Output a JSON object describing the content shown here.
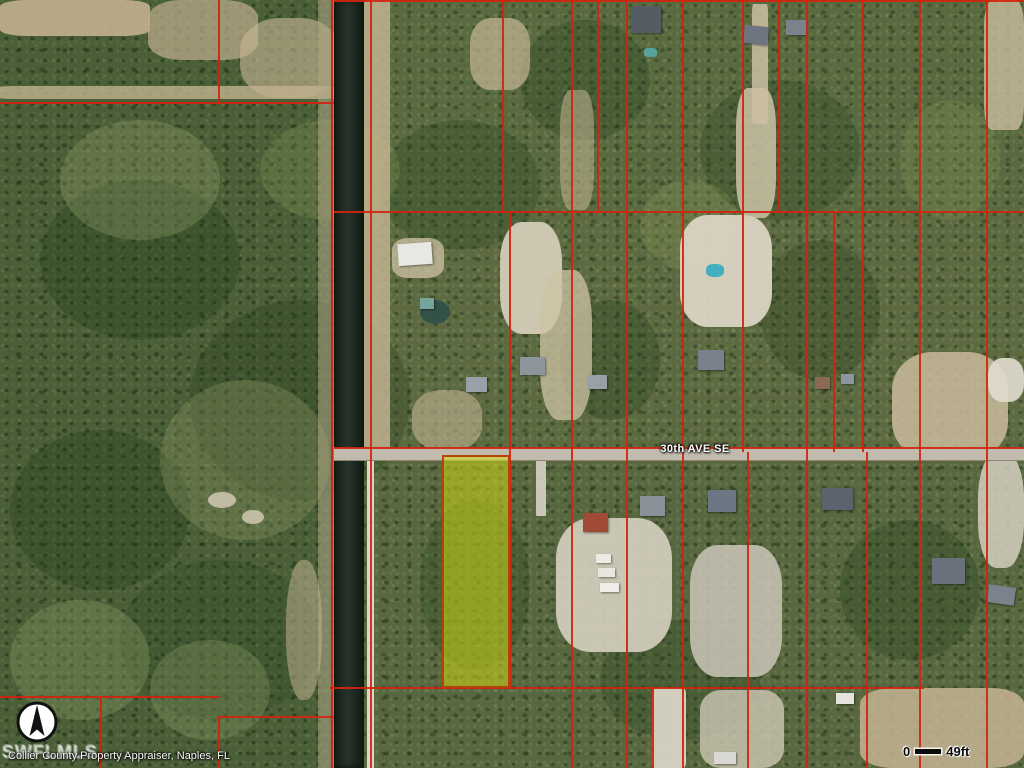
{
  "map": {
    "street_label": "30th AVE SE",
    "attribution": "Collier County Property Appraiser, Naples, FL",
    "watermark": "SWFLMLS",
    "scale_bar": {
      "start_label": "0",
      "end_label": "49ft"
    },
    "compass": {
      "icon": "north-arrow"
    },
    "colors": {
      "parcel_line": "#d3240e",
      "highlight_fill": "rgba(210,220,20,0.52)",
      "highlight_border": "#b5430a",
      "canal": "#1c2620",
      "road": "#c0bbac",
      "base_land": "#5a6a42"
    },
    "canal": {
      "x": 334,
      "y": 0,
      "w": 30,
      "h": 768
    },
    "road": {
      "x": 334,
      "y": 448,
      "w": 690,
      "h": 13
    },
    "highlight_parcel": {
      "x": 442,
      "y": 455,
      "w": 68,
      "h": 233
    },
    "parcel_lines": [
      {
        "x": 334,
        "y": 0,
        "w": 690,
        "h": 2
      },
      {
        "x": 0,
        "y": 102,
        "w": 334,
        "h": 2
      },
      {
        "x": 334,
        "y": 211,
        "w": 690,
        "h": 2
      },
      {
        "x": 334,
        "y": 447,
        "w": 690,
        "h": 2
      },
      {
        "x": 330,
        "y": 687,
        "w": 594,
        "h": 2
      },
      {
        "x": 0,
        "y": 696,
        "w": 220,
        "h": 2
      },
      {
        "x": 218,
        "y": 716,
        "w": 116,
        "h": 2
      },
      {
        "x": 218,
        "y": 0,
        "w": 2,
        "h": 104
      },
      {
        "x": 331,
        "y": 0,
        "w": 2,
        "h": 768
      },
      {
        "x": 370,
        "y": 0,
        "w": 2,
        "h": 768
      },
      {
        "x": 502,
        "y": 0,
        "w": 2,
        "h": 213
      },
      {
        "x": 571,
        "y": 0,
        "w": 2,
        "h": 768
      },
      {
        "x": 597,
        "y": 0,
        "w": 2,
        "h": 213
      },
      {
        "x": 626,
        "y": 0,
        "w": 2,
        "h": 768
      },
      {
        "x": 682,
        "y": 0,
        "w": 2,
        "h": 768
      },
      {
        "x": 742,
        "y": 0,
        "w": 2,
        "h": 452
      },
      {
        "x": 747,
        "y": 452,
        "w": 2,
        "h": 316
      },
      {
        "x": 778,
        "y": 0,
        "w": 2,
        "h": 213
      },
      {
        "x": 806,
        "y": 0,
        "w": 2,
        "h": 768
      },
      {
        "x": 833,
        "y": 211,
        "w": 2,
        "h": 241
      },
      {
        "x": 862,
        "y": 0,
        "w": 2,
        "h": 452
      },
      {
        "x": 866,
        "y": 452,
        "w": 2,
        "h": 316
      },
      {
        "x": 919,
        "y": 0,
        "w": 2,
        "h": 768
      },
      {
        "x": 986,
        "y": 0,
        "w": 2,
        "h": 768
      },
      {
        "x": 509,
        "y": 211,
        "w": 2,
        "h": 478
      },
      {
        "x": 100,
        "y": 696,
        "w": 2,
        "h": 72
      },
      {
        "x": 218,
        "y": 716,
        "w": 2,
        "h": 52
      },
      {
        "x": 652,
        "y": 687,
        "w": 2,
        "h": 81
      }
    ],
    "patches": [
      {
        "x": 0,
        "y": 0,
        "w": 333,
        "h": 768,
        "c": "#223f1d",
        "o": 0.28,
        "r": 0
      },
      {
        "x": 333,
        "y": 0,
        "w": 691,
        "h": 212,
        "c": "#5d6b3c",
        "o": 0.25,
        "r": 0
      },
      {
        "x": 333,
        "y": 212,
        "w": 691,
        "h": 240,
        "c": "#6a6f42",
        "o": 0.2,
        "r": 0
      },
      {
        "x": 333,
        "y": 460,
        "w": 691,
        "h": 308,
        "c": "#4f6038",
        "o": 0.2,
        "r": 0
      },
      {
        "x": 40,
        "y": 180,
        "w": 200,
        "h": 160,
        "c": "#1f3a1a",
        "o": 0.3,
        "r": 50
      },
      {
        "x": 190,
        "y": 300,
        "w": 220,
        "h": 200,
        "c": "#1f3a1a",
        "o": 0.28,
        "r": 50
      },
      {
        "x": 10,
        "y": 430,
        "w": 180,
        "h": 160,
        "c": "#1f3a1a",
        "o": 0.3,
        "r": 50
      },
      {
        "x": 120,
        "y": 560,
        "w": 200,
        "h": 160,
        "c": "#254220",
        "o": 0.25,
        "r": 50
      },
      {
        "x": 520,
        "y": 20,
        "w": 130,
        "h": 120,
        "c": "#1f3a1a",
        "o": 0.28,
        "r": 50
      },
      {
        "x": 380,
        "y": 120,
        "w": 160,
        "h": 130,
        "c": "#24421f",
        "o": 0.3,
        "r": 50
      },
      {
        "x": 560,
        "y": 300,
        "w": 100,
        "h": 120,
        "c": "#1f3a1a",
        "o": 0.3,
        "r": 50
      },
      {
        "x": 700,
        "y": 80,
        "w": 160,
        "h": 140,
        "c": "#24421f",
        "o": 0.28,
        "r": 50
      },
      {
        "x": 760,
        "y": 240,
        "w": 120,
        "h": 140,
        "c": "#1f3a1a",
        "o": 0.28,
        "r": 50
      },
      {
        "x": 840,
        "y": 520,
        "w": 140,
        "h": 140,
        "c": "#1f3a1a",
        "o": 0.3,
        "r": 50
      },
      {
        "x": 600,
        "y": 620,
        "w": 160,
        "h": 120,
        "c": "#24421f",
        "o": 0.28,
        "r": 50
      },
      {
        "x": 420,
        "y": 500,
        "w": 110,
        "h": 170,
        "c": "#2a4a22",
        "o": 0.3,
        "r": 50
      },
      {
        "x": 60,
        "y": 120,
        "w": 160,
        "h": 120,
        "c": "#9aa472",
        "o": 0.3,
        "r": 50
      },
      {
        "x": 260,
        "y": 120,
        "w": 140,
        "h": 100,
        "c": "#8fa05c",
        "o": 0.25,
        "r": 50
      },
      {
        "x": 640,
        "y": 180,
        "w": 100,
        "h": 90,
        "c": "#8fa05c",
        "o": 0.25,
        "r": 50
      },
      {
        "x": 900,
        "y": 100,
        "w": 100,
        "h": 120,
        "c": "#8fa05c",
        "o": 0.22,
        "r": 50
      },
      {
        "x": 160,
        "y": 380,
        "w": 170,
        "h": 160,
        "c": "#97a06b",
        "o": 0.3,
        "r": 50
      },
      {
        "x": 10,
        "y": 600,
        "w": 140,
        "h": 120,
        "c": "#8a9a64",
        "o": 0.35,
        "r": 50
      },
      {
        "x": 150,
        "y": 640,
        "w": 120,
        "h": 100,
        "c": "#93a06a",
        "o": 0.3,
        "r": 50
      },
      {
        "x": 0,
        "y": 0,
        "w": 150,
        "h": 36,
        "c": "#c3b08e",
        "o": 0.9,
        "r": 18
      },
      {
        "x": 148,
        "y": 0,
        "w": 110,
        "h": 60,
        "c": "#bfae8f",
        "o": 0.7,
        "r": 30
      },
      {
        "x": 240,
        "y": 18,
        "w": 100,
        "h": 80,
        "c": "#c8b896",
        "o": 0.6,
        "r": 40
      },
      {
        "x": 0,
        "y": 86,
        "w": 334,
        "h": 13,
        "c": "#c2b28f",
        "o": 0.8,
        "r": 6
      },
      {
        "x": 318,
        "y": 0,
        "w": 16,
        "h": 768,
        "c": "#b3a687",
        "o": 0.55,
        "r": 0
      },
      {
        "x": 364,
        "y": 0,
        "w": 26,
        "h": 452,
        "c": "#c2b391",
        "o": 0.85,
        "r": 0
      },
      {
        "x": 367,
        "y": 455,
        "w": 7,
        "h": 313,
        "c": "#e8e4d8",
        "o": 0.9,
        "r": 0
      },
      {
        "x": 470,
        "y": 18,
        "w": 60,
        "h": 72,
        "c": "#c6b795",
        "o": 0.7,
        "r": 35
      },
      {
        "x": 392,
        "y": 238,
        "w": 52,
        "h": 40,
        "c": "#cfc3a6",
        "o": 0.75,
        "r": 30
      },
      {
        "x": 412,
        "y": 390,
        "w": 70,
        "h": 60,
        "c": "#c2b292",
        "o": 0.6,
        "r": 40
      },
      {
        "x": 500,
        "y": 222,
        "w": 62,
        "h": 112,
        "c": "#d9d2bf",
        "o": 0.9,
        "r": 35
      },
      {
        "x": 540,
        "y": 270,
        "w": 52,
        "h": 150,
        "c": "#cec3a4",
        "o": 0.75,
        "r": 35
      },
      {
        "x": 560,
        "y": 90,
        "w": 34,
        "h": 120,
        "c": "#c3b494",
        "o": 0.55,
        "r": 30
      },
      {
        "x": 680,
        "y": 215,
        "w": 92,
        "h": 112,
        "c": "#ded8c8",
        "o": 0.92,
        "r": 30
      },
      {
        "x": 736,
        "y": 88,
        "w": 40,
        "h": 130,
        "c": "#d5c9ae",
        "o": 0.8,
        "r": 30
      },
      {
        "x": 752,
        "y": 4,
        "w": 16,
        "h": 120,
        "c": "#cdc0a4",
        "o": 0.85,
        "r": 8
      },
      {
        "x": 984,
        "y": 0,
        "w": 40,
        "h": 130,
        "c": "#c9bb9c",
        "o": 0.8,
        "r": 20
      },
      {
        "x": 892,
        "y": 352,
        "w": 116,
        "h": 108,
        "c": "#c9bb9c",
        "o": 0.85,
        "r": 35
      },
      {
        "x": 988,
        "y": 358,
        "w": 36,
        "h": 44,
        "c": "#e2ddd0",
        "o": 0.9,
        "r": 40
      },
      {
        "x": 556,
        "y": 518,
        "w": 116,
        "h": 134,
        "c": "#d6d0c0",
        "o": 0.9,
        "r": 30
      },
      {
        "x": 690,
        "y": 545,
        "w": 92,
        "h": 132,
        "c": "#cbc6b8",
        "o": 0.85,
        "r": 30
      },
      {
        "x": 860,
        "y": 688,
        "w": 164,
        "h": 80,
        "c": "#c4b493",
        "o": 0.85,
        "r": 20
      },
      {
        "x": 700,
        "y": 690,
        "w": 84,
        "h": 78,
        "c": "#cfc8b6",
        "o": 0.8,
        "r": 25
      },
      {
        "x": 652,
        "y": 688,
        "w": 34,
        "h": 80,
        "c": "#d9d4c6",
        "o": 0.95,
        "r": 8
      },
      {
        "x": 536,
        "y": 460,
        "w": 10,
        "h": 56,
        "c": "#d8d3c5",
        "o": 0.9,
        "r": 5
      },
      {
        "x": 978,
        "y": 452,
        "w": 46,
        "h": 116,
        "c": "#d5cfc1",
        "o": 0.85,
        "r": 40
      },
      {
        "x": 286,
        "y": 560,
        "w": 36,
        "h": 140,
        "c": "#c0b190",
        "o": 0.55,
        "r": 45
      },
      {
        "x": 208,
        "y": 492,
        "w": 28,
        "h": 16,
        "c": "#d8d0bc",
        "o": 0.8,
        "r": 50
      },
      {
        "x": 242,
        "y": 510,
        "w": 22,
        "h": 14,
        "c": "#d8d0bc",
        "o": 0.8,
        "r": 50
      },
      {
        "x": 420,
        "y": 300,
        "w": 30,
        "h": 24,
        "c": "#31504a",
        "o": 0.95,
        "r": 50
      },
      {
        "x": 706,
        "y": 264,
        "w": 18,
        "h": 13,
        "c": "#43b0c2",
        "o": 1,
        "r": 40
      },
      {
        "x": 644,
        "y": 48,
        "w": 13,
        "h": 9,
        "c": "#57a29a",
        "o": 1,
        "r": 30
      }
    ],
    "houses": [
      {
        "x": 398,
        "y": 243,
        "w": 34,
        "h": 22,
        "c": "#e9e7e1",
        "rot": -4
      },
      {
        "x": 420,
        "y": 298,
        "w": 14,
        "h": 11,
        "c": "#74a49c",
        "rot": 0
      },
      {
        "x": 466,
        "y": 377,
        "w": 21,
        "h": 15,
        "c": "#99a0a8",
        "rot": 0
      },
      {
        "x": 520,
        "y": 357,
        "w": 25,
        "h": 18,
        "c": "#8e949c",
        "rot": 0
      },
      {
        "x": 588,
        "y": 375,
        "w": 19,
        "h": 14,
        "c": "#9aa0a8",
        "rot": 0
      },
      {
        "x": 698,
        "y": 350,
        "w": 26,
        "h": 20,
        "c": "#79818c",
        "rot": 0
      },
      {
        "x": 815,
        "y": 377,
        "w": 15,
        "h": 12,
        "c": "#8a6a52",
        "rot": 0
      },
      {
        "x": 841,
        "y": 374,
        "w": 13,
        "h": 10,
        "c": "#8f959d",
        "rot": 0
      },
      {
        "x": 631,
        "y": 6,
        "w": 30,
        "h": 27,
        "c": "#555c64",
        "rot": 0
      },
      {
        "x": 744,
        "y": 26,
        "w": 24,
        "h": 18,
        "c": "#6e7580",
        "rot": 6
      },
      {
        "x": 786,
        "y": 20,
        "w": 20,
        "h": 15,
        "c": "#7a828c",
        "rot": 0
      },
      {
        "x": 583,
        "y": 513,
        "w": 25,
        "h": 19,
        "c": "#a14b36",
        "rot": 0
      },
      {
        "x": 640,
        "y": 496,
        "w": 25,
        "h": 20,
        "c": "#8a9098",
        "rot": 0
      },
      {
        "x": 708,
        "y": 490,
        "w": 28,
        "h": 22,
        "c": "#6d7783",
        "rot": 0
      },
      {
        "x": 822,
        "y": 488,
        "w": 31,
        "h": 22,
        "c": "#5d636d",
        "rot": 0
      },
      {
        "x": 932,
        "y": 558,
        "w": 33,
        "h": 26,
        "c": "#6a717d",
        "rot": 0
      },
      {
        "x": 988,
        "y": 586,
        "w": 27,
        "h": 18,
        "c": "#7b828c",
        "rot": 8
      },
      {
        "x": 596,
        "y": 554,
        "w": 15,
        "h": 9,
        "c": "#edebe5",
        "rot": 0
      },
      {
        "x": 598,
        "y": 568,
        "w": 17,
        "h": 9,
        "c": "#e8e6e0",
        "rot": 0
      },
      {
        "x": 600,
        "y": 583,
        "w": 19,
        "h": 9,
        "c": "#efede7",
        "rot": 0
      },
      {
        "x": 836,
        "y": 693,
        "w": 18,
        "h": 11,
        "c": "#e5e3dd",
        "rot": 0
      },
      {
        "x": 714,
        "y": 752,
        "w": 22,
        "h": 12,
        "c": "#dad8d2",
        "rot": 0
      }
    ]
  }
}
